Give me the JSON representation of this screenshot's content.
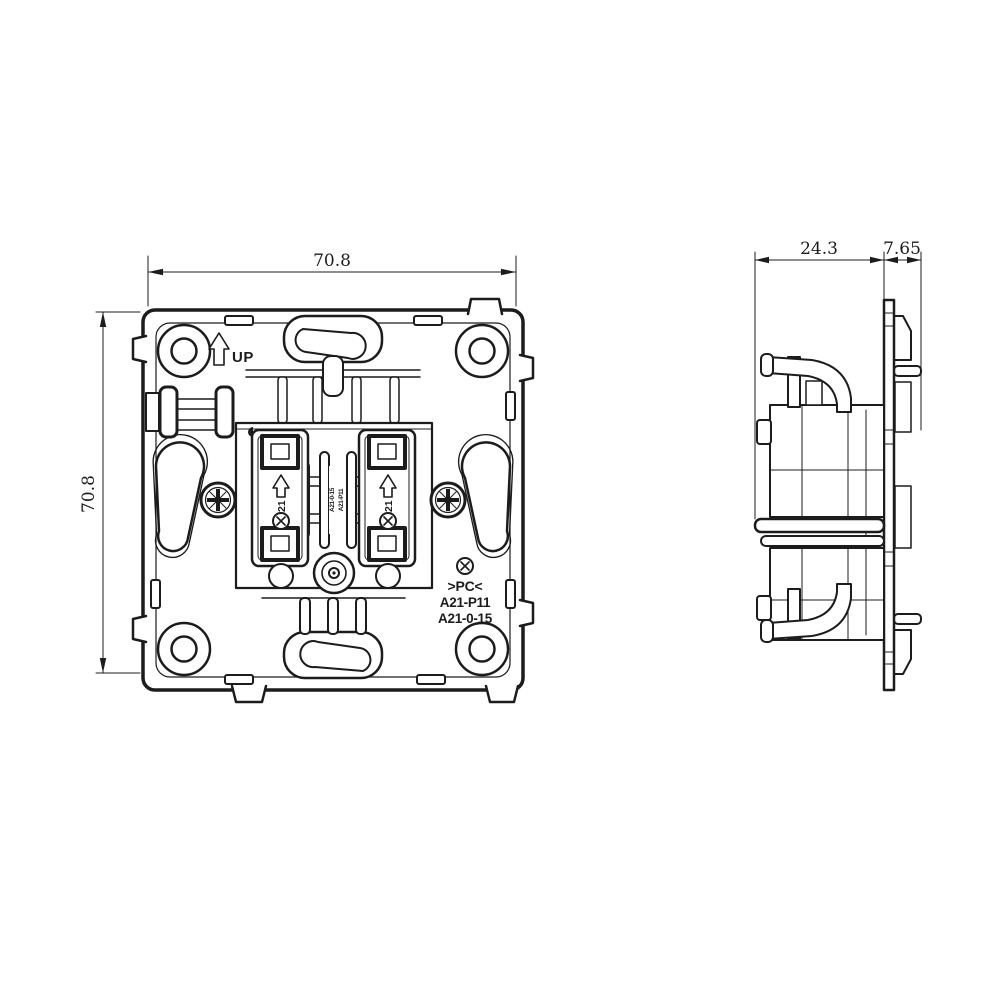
{
  "colors": {
    "line": "#1c1c1c",
    "background": "#ffffff"
  },
  "dimensions": {
    "front_width": "70.8",
    "front_height": "70.8",
    "side_body_depth": "24.3",
    "side_flange_depth": "7.65"
  },
  "front_view": {
    "up_label": "UP",
    "module_left_label": "A21",
    "module_right_label": "A21",
    "center_stamp_col1": "A21-0-15",
    "center_stamp_col2": "A21-P11",
    "material_mark": ">PC<",
    "part_number_1": "A21-P11",
    "part_number_2": "A21-0-15"
  },
  "icons": {
    "screw": "pozidriv-screw",
    "orientation_arrow": "up-arrow",
    "crossed_circle": "circled-x"
  }
}
